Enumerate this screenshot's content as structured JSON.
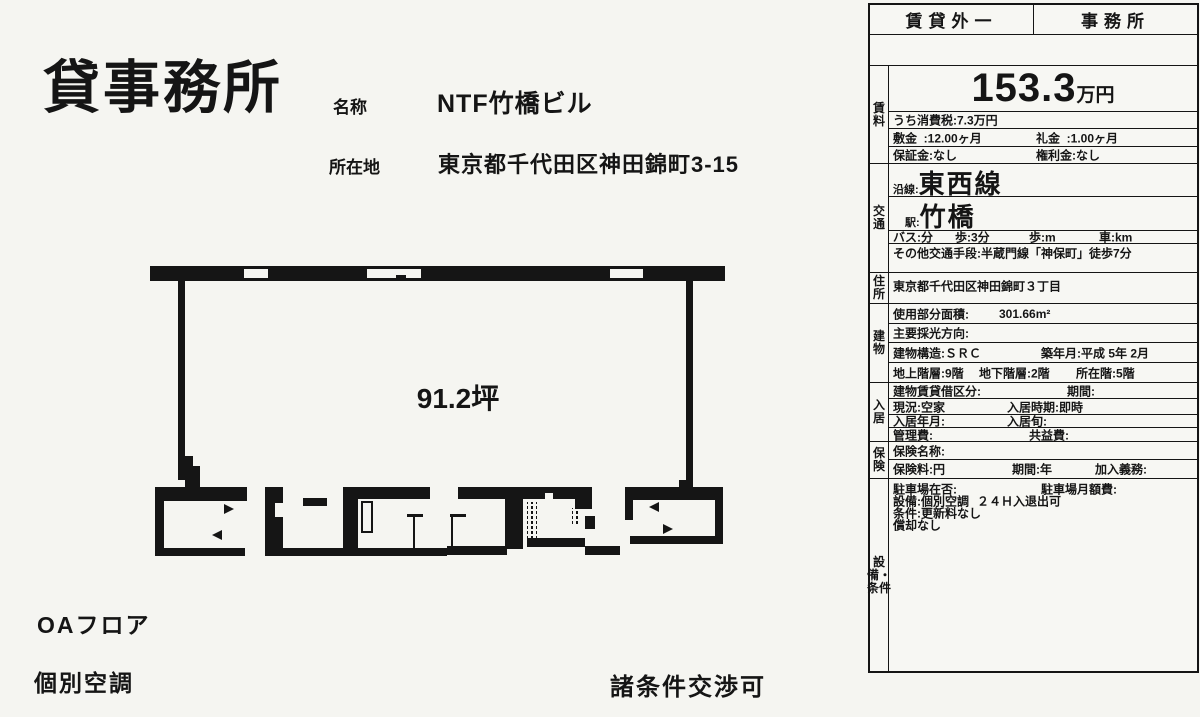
{
  "colors": {
    "ink": "#151515",
    "paper": "#f5f5f1"
  },
  "page": {
    "title": "貸事務所",
    "name_label": "名称",
    "name_value": "NTF竹橋ビル",
    "location_label": "所在地",
    "location_value": "東京都千代田区神田錦町3-15",
    "floor_area_label": "91.2坪",
    "feature_oa_floor": "OAフロア",
    "feature_aircon": "個別空調",
    "note": "諸条件交渉可"
  },
  "table": {
    "header": {
      "left": "賃貸外一",
      "right": "事務所"
    },
    "rent": {
      "label": "賃料",
      "amount": "153.3",
      "amount_unit": "万円",
      "tax": "うち消費税:7.3万円",
      "deposit": "敷金  :12.00ヶ月",
      "key_money": "礼金  :1.00ヶ月",
      "guarantee": "保証金:なし",
      "rights": "権利金:なし"
    },
    "transport": {
      "label": "交通",
      "line_label": "沿線:",
      "line": "東西線",
      "station_label": "駅:",
      "station": "竹橋",
      "bus": "バス:分",
      "walk": "歩:3分",
      "walk2": "歩:m",
      "car": "車:km",
      "other": "その他交通手段:半蔵門線「神保町」徒歩7分"
    },
    "address": {
      "label": "住所",
      "value": "東京都千代田区神田錦町３丁目"
    },
    "building": {
      "label": "建物",
      "area_label": "使用部分面積:",
      "area_value": "301.66m²",
      "light": "主要採光方向:",
      "structure": "建物構造:ＳＲＣ",
      "built": "築年月:平成 5年 2月",
      "floors_above": "地上階層:9階",
      "floors_below": "地下階層:2階",
      "floor_located": "所在階:5階"
    },
    "occupancy": {
      "label": "入居",
      "lease_type": "建物賃貸借区分:",
      "period": "期間:",
      "status": "現況:空家",
      "move_in": "入居時期:即時",
      "move_in_ym": "入居年月:",
      "move_in_season": "入居旬:",
      "mgmt_fee": "管理費:",
      "common_fee": "共益費:"
    },
    "insurance": {
      "label": "保険",
      "name": "保険名称:",
      "fee": "保険料:円",
      "period": "期間:年",
      "obligation": "加入義務:"
    },
    "facilities": {
      "label": "設備・条件",
      "parking": "駐車場在否:",
      "parking_fee": "駐車場月額費:",
      "equipment": "設備:個別空調",
      "access": "２４Ｈ入退出可",
      "condition1": "条件:更新料なし",
      "condition2": "償却なし"
    }
  }
}
